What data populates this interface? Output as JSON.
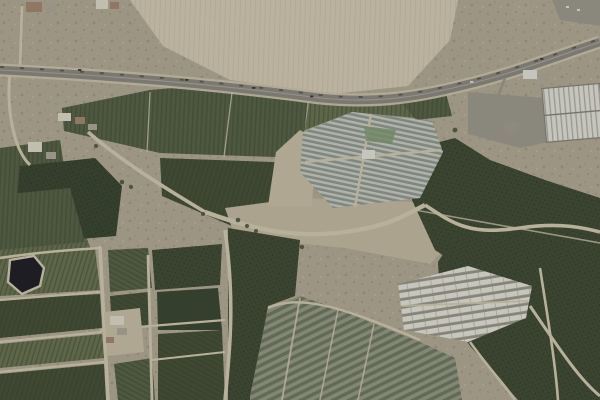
{
  "meta": {
    "kind": "satellite-aerial-imagery",
    "scene": "agricultural patchwork with highway, greenhouses, orchards and industrial building"
  },
  "landCover": {
    "plowedField": "bare plowed field",
    "highway": "dual-carriageway highway",
    "warehouse": "industrial warehouse",
    "yard": "industrial yard",
    "greenhouseComplex": "silver greenhouse complex",
    "orchard": "dark orchard block",
    "nettedField": "shade-netted vineyard parcels",
    "whiteGreenhouses": "white greenhouse rows",
    "pond": "irrigation pond",
    "village": "rural houses",
    "scrub": "dry scrubland",
    "dirtRoad": "dirt farm road"
  },
  "palette": {
    "scrubBase": "#b9b09c",
    "scrubDot": "#8b8670",
    "scrubLight": "#d3cab4",
    "paleField": "#dbd2bd",
    "paleLine": "#c8beа6",
    "paleLine2": "#c8bea6",
    "dirtRoad": "#d8cfb8",
    "dirtOpen": "#c9bfa8",
    "dirtOpen2": "#cfc5ae",
    "asphalt": "#8f8d85",
    "asphaltDark": "#55534b",
    "shoulder": "#d2c9b3",
    "median": "#b7b4aa",
    "vehicleDark": "#3f3d37",
    "vehicleLight": "#e8e6df",
    "greenMid": "#5c684c",
    "greenLight": "#6e7858",
    "greenDark": "#4a553d",
    "greenRow": "#39452f",
    "orchardDark": "#46513a",
    "orchardDot": "#2f3a28",
    "orchardSmooth": "#3e4a35",
    "nettedBase": "#99a08b",
    "nettedStripe": "#6d7562",
    "ghDark": "#979e98",
    "ghLight": "#ced3cd",
    "ghGreen": "#87a078",
    "ghCenterBldg": "#e9e8e2",
    "whiteGhBar": "#eae9e2",
    "whiteGhGap": "#9c9b8e",
    "yardGrey": "#a3a096",
    "warehouse": "#e8e7e1",
    "warehouseRib": "#b2b0a8",
    "warehouseEdge": "#8a887f",
    "bldgWhite": "#e4dfd2",
    "bldgGrey": "#b4aca0",
    "roofRed": "#a98c76",
    "pond": "#24222b",
    "pondRim": "#d8cfba",
    "tree": "#4c5539"
  }
}
